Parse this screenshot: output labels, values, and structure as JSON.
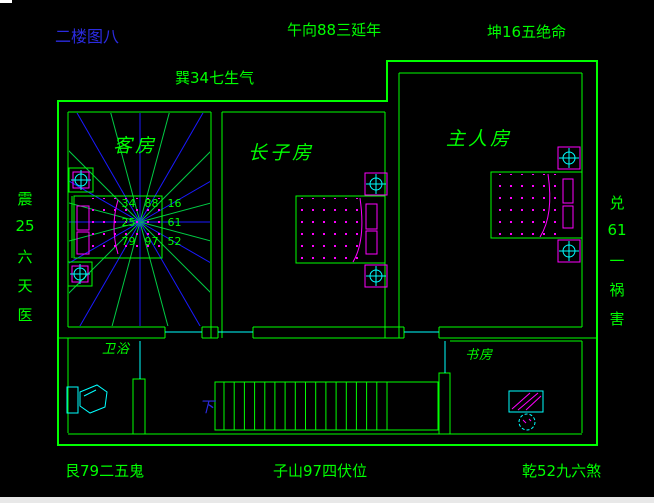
{
  "title": "二楼图八",
  "compass": {
    "top_left": "巽34七生气",
    "top_center": "午向88三延年",
    "top_right": "坤16五绝命",
    "bottom_left": "艮79二五鬼",
    "bottom_center": "子山97四伏位",
    "bottom_right": "乾52九六煞",
    "left": [
      "震",
      "25",
      "六",
      "天",
      "医"
    ],
    "right": [
      "兑",
      "61",
      "一",
      "祸",
      "害"
    ]
  },
  "rooms": {
    "guest": "客房",
    "eldest_son": "长子房",
    "master": "主人房",
    "bathroom": "卫浴",
    "study": "书房"
  },
  "luoshu": [
    [
      "34",
      "88",
      "16"
    ],
    [
      "25",
      "",
      "61"
    ],
    [
      "79",
      "97",
      "52"
    ]
  ],
  "stairs": {
    "down_label": "下",
    "tread_count": 17
  },
  "colors": {
    "background": "#000000",
    "wall": "#00ff00",
    "door": "#00ffff",
    "ray_blue": "#1a1aff",
    "ray_green": "#00cc44",
    "furniture_cyan": "#00ffff",
    "accent_magenta": "#ff00ff",
    "label_green": "#00ff00",
    "title_blue": "#2b2be0"
  }
}
